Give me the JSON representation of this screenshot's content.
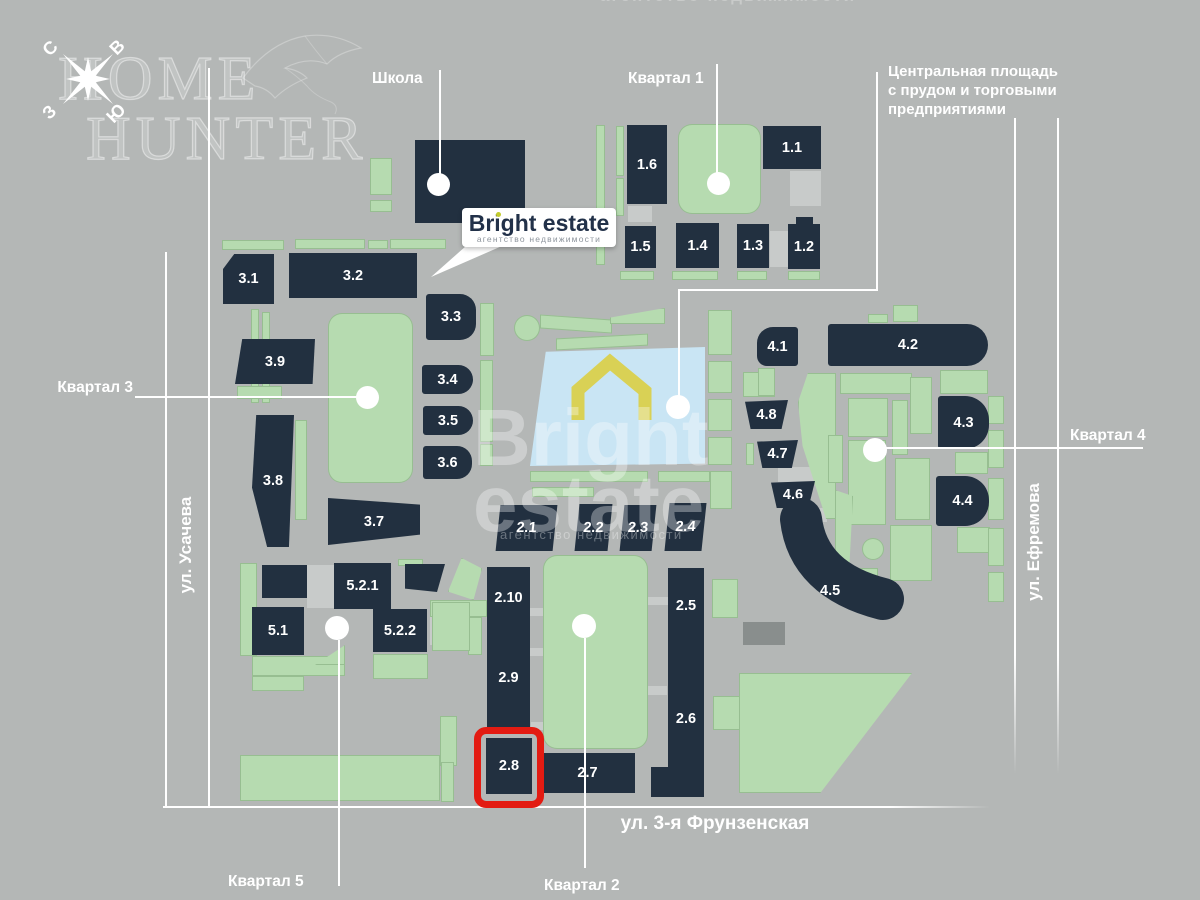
{
  "colors": {
    "background": "#b4b7b6",
    "building": "#223040",
    "green": "#b6dbb0",
    "pond": "#c9e5f4",
    "highlight_red": "#e31b12",
    "logo_accent": "#c3cc2e",
    "house_icon_yellow": "#d9d155"
  },
  "compass": {
    "n": "С",
    "e": "В",
    "w": "З",
    "s": "Ю"
  },
  "watermark_corner": {
    "line1": "HOME",
    "line2": "HUNTER"
  },
  "watermark_center": {
    "line1": "Bright",
    "line2": "estate",
    "tagline": "агентство недвижимости"
  },
  "watermark_top": "агентство недвижимости",
  "logo": {
    "brand": "Bright estate",
    "tagline": "агентство недвижимости"
  },
  "labels": {
    "school": "Школа",
    "quarter_1": "Квартал 1",
    "quarter_2": "Квартал 2",
    "quarter_3": "Квартал 3",
    "quarter_4": "Квартал 4",
    "quarter_5": "Квартал 5",
    "central_square_line1": "Центральная площадь",
    "central_square_line2": "с прудом и торговыми",
    "central_square_line3": "предприятиями",
    "street_west": "ул. Усачева",
    "street_east": "ул. Ефремова",
    "street_south": "ул. 3-я Фрунзенская"
  },
  "highlighted_building": "2.8",
  "buildings": {
    "b1_1": "1.1",
    "b1_2": "1.2",
    "b1_3": "1.3",
    "b1_4": "1.4",
    "b1_5": "1.5",
    "b1_6": "1.6",
    "b2_1": "2.1",
    "b2_2": "2.2",
    "b2_3": "2.3",
    "b2_4": "2.4",
    "b2_5": "2.5",
    "b2_6": "2.6",
    "b2_7": "2.7",
    "b2_8": "2.8",
    "b2_9": "2.9",
    "b2_10": "2.10",
    "b3_1": "3.1",
    "b3_2": "3.2",
    "b3_3": "3.3",
    "b3_4": "3.4",
    "b3_5": "3.5",
    "b3_6": "3.6",
    "b3_7": "3.7",
    "b3_8": "3.8",
    "b3_9": "3.9",
    "b4_1": "4.1",
    "b4_2": "4.2",
    "b4_3": "4.3",
    "b4_4": "4.4",
    "b4_5": "4.5",
    "b4_6": "4.6",
    "b4_7": "4.7",
    "b4_8": "4.8",
    "b5_1": "5.1",
    "b5_2_1": "5.2.1",
    "b5_2_2": "5.2.2"
  }
}
